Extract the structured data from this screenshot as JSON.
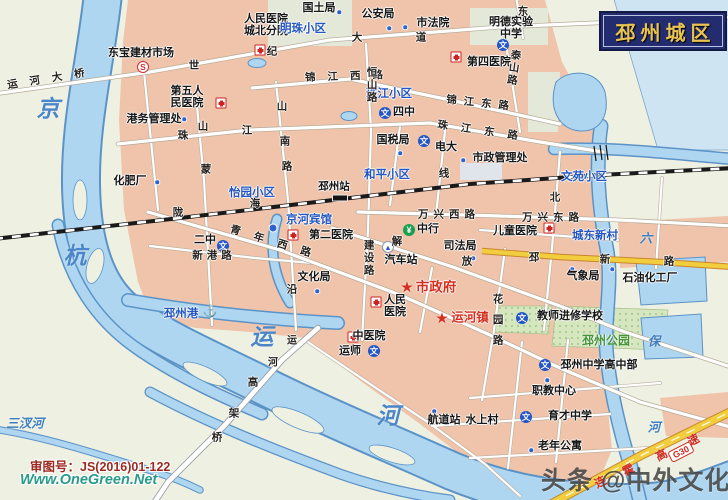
{
  "title": "邳州城区",
  "watermarks": {
    "approval": "审图号：JS(2016)01-122",
    "site": "Www.OneGreen.Net",
    "toutiao": "头条 @中外文化博览"
  },
  "highway": {
    "badge": "G30",
    "name": "连霍高速"
  },
  "colors": {
    "land": "#eef0e2",
    "urban": "#efc4ab",
    "water": "#aed6f0",
    "water_edge": "#5b93c7",
    "pale_water": "#cfe4f3",
    "road_fill": "#ffffff",
    "yellow_road": "#f2ce3e",
    "title_bg": "#232c6e",
    "title_text": "#e9c351",
    "area_text": "#2356c0",
    "gov_text": "#d43020",
    "park_text": "#46953a"
  },
  "labels": [
    {
      "t": "运河大桥",
      "x": 52,
      "y": 79,
      "c": "road",
      "ls": 12,
      "r": -9
    },
    {
      "t": "世",
      "x": 194,
      "y": 66,
      "c": "road"
    },
    {
      "t": "纪",
      "x": 272,
      "y": 52,
      "c": "road"
    },
    {
      "t": "大",
      "x": 357,
      "y": 38,
      "c": "road"
    },
    {
      "t": "道",
      "x": 421,
      "y": 38,
      "c": "road"
    },
    {
      "t": "东宝建材市场",
      "x": 141,
      "y": 54,
      "c": "poi"
    },
    {
      "t": "第五人\n民医院",
      "x": 187,
      "y": 98,
      "c": "poi"
    },
    {
      "t": "港务管理处",
      "x": 154,
      "y": 120,
      "c": "poi"
    },
    {
      "t": "化肥厂",
      "x": 130,
      "y": 182,
      "c": "poi"
    },
    {
      "t": "人民医院\n城北分院",
      "x": 266,
      "y": 26,
      "c": "poi"
    },
    {
      "t": "国土局",
      "x": 319,
      "y": 9,
      "c": "poi"
    },
    {
      "t": "公安局",
      "x": 378,
      "y": 15,
      "c": "poi"
    },
    {
      "t": "市法院",
      "x": 433,
      "y": 24,
      "c": "poi"
    },
    {
      "t": "明德实验\n中学",
      "x": 511,
      "y": 29,
      "c": "poi"
    },
    {
      "t": "第四医院",
      "x": 489,
      "y": 63,
      "c": "poi"
    },
    {
      "t": "明珠小区",
      "x": 303,
      "y": 29,
      "c": "area"
    },
    {
      "t": "珠江小区",
      "x": 389,
      "y": 94,
      "c": "area"
    },
    {
      "t": "四中",
      "x": 404,
      "y": 113,
      "c": "poi"
    },
    {
      "t": "国税局",
      "x": 393,
      "y": 141,
      "c": "poi"
    },
    {
      "t": "电大",
      "x": 446,
      "y": 148,
      "c": "poi"
    },
    {
      "t": "市政管理处",
      "x": 500,
      "y": 159,
      "c": "poi"
    },
    {
      "t": "珠",
      "x": 183,
      "y": 136,
      "c": "road"
    },
    {
      "t": "江",
      "x": 247,
      "y": 131,
      "c": "road"
    },
    {
      "t": "珠江东路",
      "x": 484,
      "y": 132,
      "c": "road",
      "ls": 13,
      "r": 8
    },
    {
      "t": "锦江西路",
      "x": 350,
      "y": 77,
      "c": "road",
      "ls": 12,
      "r": -2
    },
    {
      "t": "锦江东路",
      "x": 481,
      "y": 104,
      "c": "road",
      "ls": 7,
      "r": 6
    },
    {
      "t": "恒山路",
      "x": 371,
      "y": 85,
      "c": "road",
      "v": 1,
      "ls": 2
    },
    {
      "t": "泰山路",
      "x": 513,
      "y": 68,
      "c": "road",
      "v": 1,
      "ls": 2,
      "r": 8
    },
    {
      "t": "山",
      "x": 282,
      "y": 107,
      "c": "road"
    },
    {
      "t": "南",
      "x": 285,
      "y": 142,
      "c": "road"
    },
    {
      "t": "路",
      "x": 287,
      "y": 167,
      "c": "road"
    },
    {
      "t": "山",
      "x": 203,
      "y": 127,
      "c": "road"
    },
    {
      "t": "蒙",
      "x": 206,
      "y": 170,
      "c": "road"
    },
    {
      "t": "陇",
      "x": 178,
      "y": 213,
      "c": "road"
    },
    {
      "t": "海",
      "x": 255,
      "y": 204,
      "c": "road"
    },
    {
      "t": "线",
      "x": 444,
      "y": 174,
      "c": "road"
    },
    {
      "t": "邳州站",
      "x": 334,
      "y": 187,
      "c": "poi",
      "s": 10.5
    },
    {
      "t": "和平小区",
      "x": 387,
      "y": 175,
      "c": "area"
    },
    {
      "t": "怡园小区",
      "x": 252,
      "y": 193,
      "c": "area"
    },
    {
      "t": "文苑小区",
      "x": 584,
      "y": 177,
      "c": "area"
    },
    {
      "t": "京河宾馆",
      "x": 309,
      "y": 220,
      "c": "area"
    },
    {
      "t": "第二医院",
      "x": 331,
      "y": 236,
      "c": "poi"
    },
    {
      "t": "中行",
      "x": 428,
      "y": 230,
      "c": "poi"
    },
    {
      "t": "司法局",
      "x": 460,
      "y": 247,
      "c": "poi"
    },
    {
      "t": "汽车站",
      "x": 401,
      "y": 261,
      "c": "poi"
    },
    {
      "t": "青年西路",
      "x": 277,
      "y": 244,
      "c": "road",
      "ls": 14,
      "r": 17
    },
    {
      "t": "建设路",
      "x": 368,
      "y": 258,
      "c": "road",
      "v": 1,
      "ls": 2
    },
    {
      "t": "解",
      "x": 397,
      "y": 242,
      "c": "road"
    },
    {
      "t": "放",
      "x": 467,
      "y": 262,
      "c": "road"
    },
    {
      "t": "二中",
      "x": 205,
      "y": 241,
      "c": "poi"
    },
    {
      "t": "新港路",
      "x": 214,
      "y": 256,
      "c": "road",
      "ls": 4
    },
    {
      "t": "文化局",
      "x": 314,
      "y": 278,
      "c": "poi"
    },
    {
      "t": "沿",
      "x": 292,
      "y": 290,
      "c": "road"
    },
    {
      "t": "市政府",
      "x": 436,
      "y": 288,
      "c": "red",
      "s": 13.5
    },
    {
      "t": "人民\n医院",
      "x": 395,
      "y": 307,
      "c": "poi"
    },
    {
      "t": "运河镇",
      "x": 470,
      "y": 318,
      "c": "red"
    },
    {
      "t": "中医院",
      "x": 369,
      "y": 337,
      "c": "poi"
    },
    {
      "t": "运师",
      "x": 350,
      "y": 352,
      "c": "poi"
    },
    {
      "t": "邳州港",
      "x": 181,
      "y": 314,
      "c": "area"
    },
    {
      "t": "万兴西路",
      "x": 449,
      "y": 215,
      "c": "road",
      "ls": 5
    },
    {
      "t": "万兴东路",
      "x": 553,
      "y": 218,
      "c": "road",
      "ls": 5
    },
    {
      "t": "北",
      "x": 555,
      "y": 198,
      "c": "road"
    },
    {
      "t": "儿童医院",
      "x": 515,
      "y": 232,
      "c": "poi"
    },
    {
      "t": "城东新村",
      "x": 595,
      "y": 236,
      "c": "area"
    },
    {
      "t": "邳",
      "x": 534,
      "y": 258,
      "c": "road"
    },
    {
      "t": "新",
      "x": 605,
      "y": 260,
      "c": "road"
    },
    {
      "t": "路",
      "x": 669,
      "y": 262,
      "c": "road"
    },
    {
      "t": "气象局",
      "x": 583,
      "y": 277,
      "c": "poi"
    },
    {
      "t": "石油化工厂",
      "x": 650,
      "y": 279,
      "c": "poi"
    },
    {
      "t": "教师进修学校",
      "x": 570,
      "y": 317,
      "c": "poi"
    },
    {
      "t": "花园路",
      "x": 497,
      "y": 324,
      "c": "road",
      "v": 1,
      "ls": 10
    },
    {
      "t": "邳州公园",
      "x": 606,
      "y": 341,
      "c": "green"
    },
    {
      "t": "邳州中学高中部",
      "x": 599,
      "y": 366,
      "c": "poi"
    },
    {
      "t": "职教中心",
      "x": 554,
      "y": 392,
      "c": "poi"
    },
    {
      "t": "育才中学",
      "x": 570,
      "y": 417,
      "c": "poi"
    },
    {
      "t": "老年公寓",
      "x": 560,
      "y": 447,
      "c": "poi"
    },
    {
      "t": "水上村",
      "x": 482,
      "y": 421,
      "c": "poi"
    },
    {
      "t": "航道站",
      "x": 444,
      "y": 421,
      "c": "poi"
    },
    {
      "t": "高",
      "x": 253,
      "y": 383,
      "c": "road"
    },
    {
      "t": "架",
      "x": 234,
      "y": 414,
      "c": "road"
    },
    {
      "t": "桥",
      "x": 217,
      "y": 438,
      "c": "road"
    },
    {
      "t": "运",
      "x": 292,
      "y": 342,
      "c": "road",
      "s": 10
    },
    {
      "t": "河",
      "x": 273,
      "y": 364,
      "c": "road",
      "s": 10
    },
    {
      "t": "东",
      "x": 523,
      "y": 12,
      "c": "road"
    },
    {
      "t": "京",
      "x": 48,
      "y": 110,
      "c": "waterbig"
    },
    {
      "t": "杭",
      "x": 75,
      "y": 257,
      "c": "waterbig"
    },
    {
      "t": "运",
      "x": 262,
      "y": 338,
      "c": "waterbig"
    },
    {
      "t": "河",
      "x": 388,
      "y": 417,
      "c": "waterbig"
    },
    {
      "t": "三汊河",
      "x": 25,
      "y": 423,
      "c": "water"
    },
    {
      "t": "六",
      "x": 646,
      "y": 238,
      "c": "water"
    },
    {
      "t": "保",
      "x": 654,
      "y": 341,
      "c": "water"
    },
    {
      "t": "河",
      "x": 654,
      "y": 427,
      "c": "water"
    },
    {
      "t": "连",
      "x": 601,
      "y": 483,
      "c": "hwy",
      "r": -27
    },
    {
      "t": "霍",
      "x": 629,
      "y": 471,
      "c": "hwy",
      "r": -27
    },
    {
      "t": "高",
      "x": 662,
      "y": 456,
      "c": "hwy",
      "r": -27
    },
    {
      "t": "速",
      "x": 694,
      "y": 441,
      "c": "hwy",
      "r": -27
    }
  ],
  "icons": [
    {
      "k": "s",
      "x": 143,
      "y": 67
    },
    {
      "k": "cross",
      "x": 221,
      "y": 103
    },
    {
      "k": "cross",
      "x": 260,
      "y": 50
    },
    {
      "k": "cross",
      "x": 456,
      "y": 57
    },
    {
      "k": "cross",
      "x": 293,
      "y": 235
    },
    {
      "k": "cross",
      "x": 549,
      "y": 228
    },
    {
      "k": "cross",
      "x": 376,
      "y": 302
    },
    {
      "k": "cross",
      "x": 353,
      "y": 337
    },
    {
      "k": "wen",
      "x": 503,
      "y": 45
    },
    {
      "k": "wen",
      "x": 385,
      "y": 113
    },
    {
      "k": "wen",
      "x": 424,
      "y": 141
    },
    {
      "k": "wen",
      "x": 223,
      "y": 246
    },
    {
      "k": "wen",
      "x": 374,
      "y": 351
    },
    {
      "k": "wen",
      "x": 522,
      "y": 318
    },
    {
      "k": "wen",
      "x": 545,
      "y": 365
    },
    {
      "k": "wen",
      "x": 526,
      "y": 417
    },
    {
      "k": "bank",
      "x": 409,
      "y": 230
    },
    {
      "k": "bus",
      "x": 388,
      "y": 247
    },
    {
      "k": "star",
      "x": 407,
      "y": 287
    },
    {
      "k": "star",
      "x": 442,
      "y": 318
    },
    {
      "k": "hotel",
      "x": 273,
      "y": 228
    },
    {
      "k": "anchor",
      "x": 210,
      "y": 311
    },
    {
      "k": "station",
      "x": 340,
      "y": 198
    },
    {
      "k": "dot",
      "x": 339,
      "y": 12
    },
    {
      "k": "dot",
      "x": 389,
      "y": 28
    },
    {
      "k": "dot",
      "x": 405,
      "y": 27
    },
    {
      "k": "dot",
      "x": 463,
      "y": 160
    },
    {
      "k": "dot",
      "x": 400,
      "y": 153
    },
    {
      "k": "dot",
      "x": 184,
      "y": 119
    },
    {
      "k": "dot",
      "x": 157,
      "y": 182
    },
    {
      "k": "dot",
      "x": 473,
      "y": 258
    },
    {
      "k": "dot",
      "x": 317,
      "y": 291
    },
    {
      "k": "dot",
      "x": 572,
      "y": 269
    },
    {
      "k": "dot",
      "x": 612,
      "y": 269
    },
    {
      "k": "dot",
      "x": 547,
      "y": 380
    },
    {
      "k": "dot",
      "x": 531,
      "y": 450
    },
    {
      "k": "dot",
      "x": 434,
      "y": 411
    }
  ]
}
